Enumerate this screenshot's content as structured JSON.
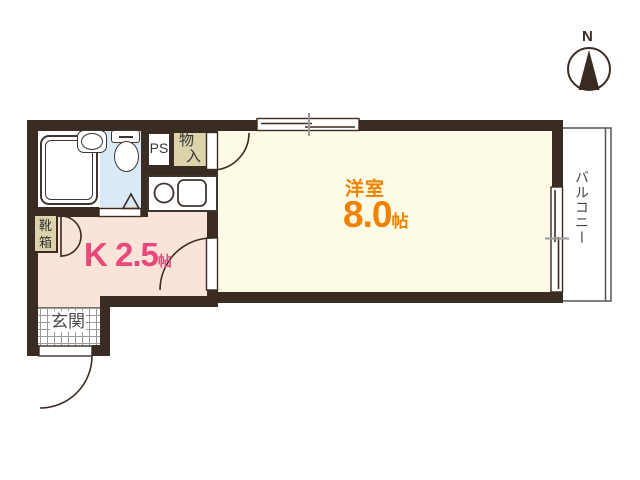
{
  "compass": {
    "north_label": "N"
  },
  "rooms": {
    "western_room": {
      "name": "洋室",
      "size": "8.0",
      "size_unit": "帖"
    },
    "kitchen": {
      "name": "K 2.5",
      "size_unit": "帖"
    },
    "entrance": {
      "name": "玄関"
    },
    "balcony": {
      "name": "バルコニー"
    },
    "shoe_cabinet": {
      "name": "靴箱",
      "line1": "靴",
      "line2": "箱"
    },
    "pipe_space": {
      "name": "PS"
    },
    "storage": {
      "name": "物入",
      "line1": "物",
      "line2": "入"
    }
  },
  "colors": {
    "wall": "#3a2b23",
    "western_room_floor": "#fdfae6",
    "kitchen_floor": "#fae4da",
    "bathroom_floor": "#d9eaf6",
    "closet_fill": "#dcd3ab",
    "room_label_orange": "#ef8200",
    "kitchen_label_pink": "#e8487a"
  }
}
